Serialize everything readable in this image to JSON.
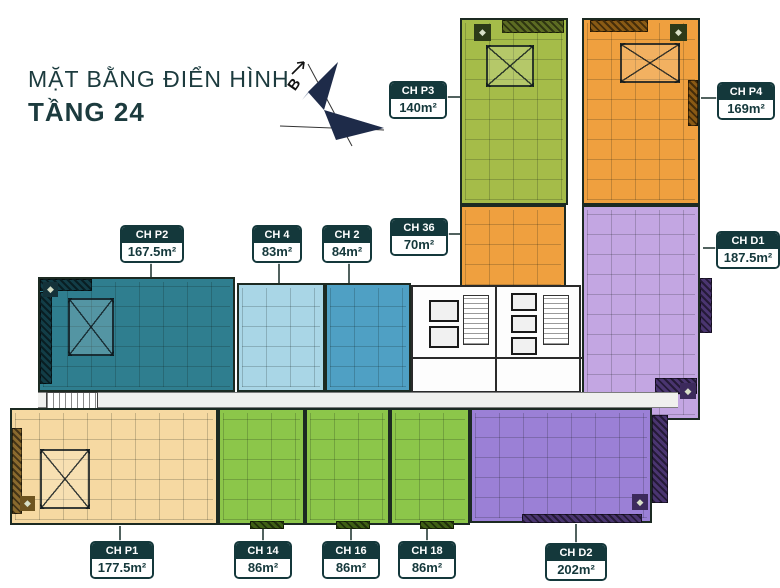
{
  "title": {
    "line1": "MẶT BẰNG ĐIỂN HÌNH",
    "line2": "TẦNG 24"
  },
  "compass": {
    "label": "B"
  },
  "icons": {
    "diamond": "◆"
  },
  "units": [
    {
      "id": "CH P3",
      "name": "CH P3",
      "area": "140m²",
      "color": "#a5bc49"
    },
    {
      "id": "CH P4",
      "name": "CH P4",
      "area": "169m²",
      "color": "#efa03f"
    },
    {
      "id": "CH P2",
      "name": "CH P2",
      "area": "167.5m²",
      "color": "#2f7e8f"
    },
    {
      "id": "CH 4",
      "name": "CH 4",
      "area": "83m²",
      "color": "#a9d6e6"
    },
    {
      "id": "CH 2",
      "name": "CH 2",
      "area": "84m²",
      "color": "#4fa0c4"
    },
    {
      "id": "CH 36",
      "name": "CH 36",
      "area": "70m²",
      "color": "#efa03f"
    },
    {
      "id": "CH D1",
      "name": "CH D1",
      "area": "187.5m²",
      "color": "#c3a6e2"
    },
    {
      "id": "CH P1",
      "name": "CH P1",
      "area": "177.5m²",
      "color": "#f6d9a2"
    },
    {
      "id": "CH 14",
      "name": "CH 14",
      "area": "86m²",
      "color": "#8cc64a"
    },
    {
      "id": "CH 16",
      "name": "CH 16",
      "area": "86m²",
      "color": "#8cc64a"
    },
    {
      "id": "CH 18",
      "name": "CH 18",
      "area": "86m²",
      "color": "#8cc64a"
    },
    {
      "id": "CH D2",
      "name": "CH D2",
      "area": "202m²",
      "color": "#9b80d6"
    }
  ]
}
